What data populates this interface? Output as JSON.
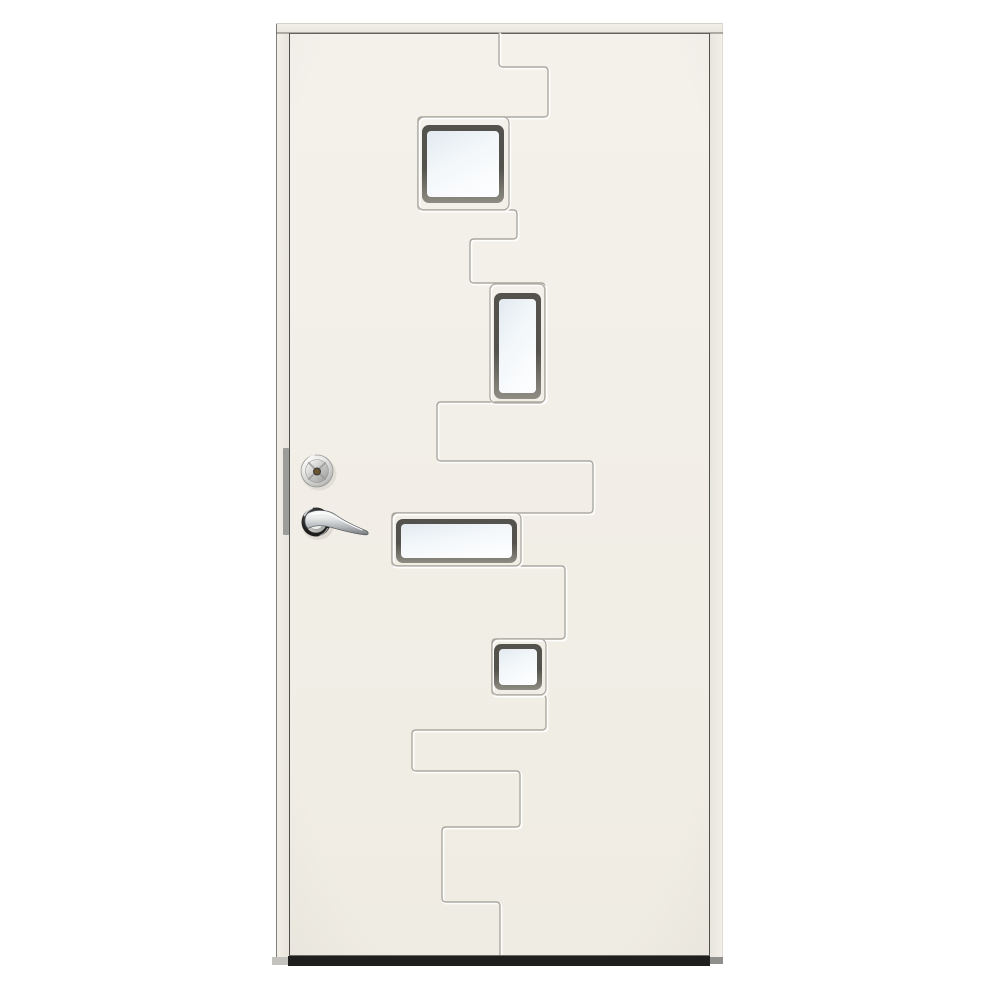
{
  "image_type": "product-photo",
  "subject": "White front entry door with stepped zigzag groove ornament, four frosted glass windows (square, tall rectangle, wide rectangle, small square), chrome lock cylinder and chrome lever handle on the left side, dark threshold at the bottom",
  "palette": {
    "background": "#ffffff",
    "door_face_top": "#f4f1eb",
    "door_face_bottom": "#efece3",
    "frame_face": "#f3f0ea",
    "frame_shade": "#e8e5dc",
    "edge_dark": "#6b6b66",
    "gap_dark": "#50504c",
    "edge_faint": "#c8c5bd",
    "groove": "#a8a49b",
    "groove_highlight": "#ffffff",
    "window_frame_top": "#53524c",
    "window_frame_bottom": "#8f8d83",
    "glass_edge": "#e2e9ef",
    "glass_mid": "#f3f7fa",
    "glass_light": "#fcfdfe",
    "threshold_dark": "#1f1f1d",
    "threshold_gray": "#c4c2bd",
    "threshold_gray2": "#8f8f8c",
    "strike_plate": "#9c9c99",
    "chrome_white": "#ffffff",
    "chrome_light": "#ebebea",
    "chrome_mid": "#c4c4c3",
    "chrome_dark": "#989896",
    "lever_top": "#ffffff",
    "lever_mid": "#e9ebec",
    "lever_low": "#b2b5b8",
    "lever_dark": "#6c7074",
    "lever_outline": "#55585c",
    "rosette_center": "#5a5a5a",
    "rosette_dark": "#1c1c1c",
    "keyhole_brass": "#6a5530",
    "keyhole_rim": "#3e3e3b",
    "shadow_soft": "#6f685c",
    "vignette": "#8a847a"
  },
  "geometry": {
    "frame_head": {
      "x": 276,
      "y": 23,
      "width": 447,
      "height": 10
    },
    "head_bottom_line": {
      "x1": 276,
      "y1": 33,
      "x2": 723,
      "y2": 33
    },
    "head_top_line": {
      "x1": 276,
      "y1": 23.5,
      "x2": 723,
      "y2": 23.5
    },
    "left_jamb": {
      "x": 276,
      "y": 33,
      "width": 13,
      "height": 925
    },
    "right_jamb": {
      "x": 710,
      "y": 33,
      "width": 13,
      "height": 925
    },
    "left_jamb_outer": {
      "x1": 276.5,
      "y1": 24,
      "x2": 276.5,
      "y2": 958
    },
    "right_jamb_outer": {
      "x1": 722.5,
      "y1": 24,
      "x2": 722.5,
      "y2": 958
    },
    "door_leaf": {
      "x": 289,
      "y": 33,
      "width": 421,
      "height": 923
    },
    "gap_left": {
      "x1": 289.5,
      "y1": 33,
      "x2": 289.5,
      "y2": 956
    },
    "gap_right": {
      "x1": 709.5,
      "y1": 33,
      "x2": 709.5,
      "y2": 956
    },
    "gap_top": {
      "x1": 290,
      "y1": 33.5,
      "x2": 710,
      "y2": 33.5
    },
    "leaf_bottom_line": {
      "x1": 289,
      "y1": 955.5,
      "x2": 710,
      "y2": 955.5
    },
    "vignette_overlay": {
      "x": 290,
      "y": 34,
      "width": 419,
      "height": 921
    },
    "groove_points": [
      [
        499,
        33
      ],
      [
        499,
        67
      ],
      [
        548,
        67
      ],
      [
        548,
        117
      ],
      [
        418,
        117
      ],
      [
        418,
        210
      ],
      [
        517,
        210
      ],
      [
        517,
        239
      ],
      [
        470,
        239
      ],
      [
        470,
        283
      ],
      [
        545,
        283
      ],
      [
        545,
        402
      ],
      [
        437,
        402
      ],
      [
        437,
        461
      ],
      [
        593,
        461
      ],
      [
        593,
        513
      ],
      [
        392,
        513
      ],
      [
        392,
        566
      ],
      [
        565,
        566
      ],
      [
        565,
        639
      ],
      [
        492,
        639
      ],
      [
        492,
        695
      ],
      [
        546,
        695
      ],
      [
        546,
        730
      ],
      [
        412,
        730
      ],
      [
        412,
        771
      ],
      [
        520,
        771
      ],
      [
        520,
        827
      ],
      [
        442,
        827
      ],
      [
        442,
        902
      ],
      [
        500,
        902
      ],
      [
        500,
        956
      ]
    ],
    "windows": {
      "w1": {
        "recess": {
          "x": 418,
          "y": 117,
          "width": 91,
          "height": 93,
          "rx": 6
        },
        "frame": {
          "x": 422,
          "y": 125,
          "width": 82,
          "height": 78,
          "rx": 7
        },
        "glass": {
          "x": 427,
          "y": 131,
          "width": 72,
          "height": 66,
          "rx": 4
        }
      },
      "w2": {
        "recess": {
          "x": 490,
          "y": 284,
          "width": 55,
          "height": 119,
          "rx": 6
        },
        "frame": {
          "x": 494,
          "y": 293,
          "width": 47,
          "height": 106,
          "rx": 7
        },
        "glass": {
          "x": 499,
          "y": 299,
          "width": 37,
          "height": 94,
          "rx": 4
        }
      },
      "w3": {
        "recess": {
          "x": 392,
          "y": 513,
          "width": 129,
          "height": 53,
          "rx": 6
        },
        "frame": {
          "x": 396,
          "y": 519,
          "width": 121,
          "height": 44,
          "rx": 7
        },
        "glass": {
          "x": 401,
          "y": 524,
          "width": 111,
          "height": 34,
          "rx": 4
        }
      },
      "w4": {
        "recess": {
          "x": 492,
          "y": 639,
          "width": 54,
          "height": 56,
          "rx": 6
        },
        "frame": {
          "x": 494,
          "y": 644,
          "width": 48,
          "height": 46,
          "rx": 7
        },
        "glass": {
          "x": 499,
          "y": 649,
          "width": 38,
          "height": 36,
          "rx": 4
        }
      }
    },
    "threshold_main": {
      "x": 288,
      "y": 956,
      "width": 422,
      "height": 10
    },
    "threshold_left": {
      "x": 272,
      "y": 957,
      "width": 16,
      "height": 8
    },
    "threshold_right": {
      "x": 710,
      "y": 957,
      "width": 13,
      "height": 7
    },
    "strike_plate": {
      "x": 283,
      "y": 448,
      "width": 6,
      "height": 87,
      "rx": 1
    },
    "cylinder_shadow": {
      "cx": 319,
      "cy": 474,
      "rx": 17.5,
      "ry": 16.5
    },
    "cylinder_outer": {
      "cx": 317,
      "cy": 471,
      "r": 16
    },
    "cylinder_inner": {
      "cx": 317,
      "cy": 471,
      "r": 11.5
    },
    "cylinder_cross_1": {
      "x1": 308.9,
      "y1": 462.9,
      "x2": 325.1,
      "y2": 479.1
    },
    "cylinder_cross_2": {
      "x1": 325.1,
      "y1": 462.9,
      "x2": 308.9,
      "y2": 479.1
    },
    "cylinder_glint": {
      "d": "M 305.5,462 A 16,16 0 0 1 314,455.4"
    },
    "keyhole": {
      "cx": 317,
      "cy": 471.5,
      "r": 3.4
    },
    "rosette_shadow": {
      "cx": 318,
      "cy": 525,
      "rx": 16,
      "ry": 15
    },
    "rosette_outer": {
      "cx": 316,
      "cy": 522,
      "r": 14.5
    },
    "rosette_ring": {
      "cx": 316,
      "cy": 522,
      "r": 11
    },
    "rosette_hub": {
      "cx": 316,
      "cy": 522,
      "r": 7.5
    },
    "rosette_glint_1": {
      "d": "M 304.5,515.5 A 14.5,14.5 0 0 1 312,508.3"
    },
    "rosette_glint_2": {
      "d": "M 327.5,528.5 A 14.5,14.5 0 0 1 320,535.5"
    },
    "lever": {
      "d": "M 309,512.5 C 319,508.5 330,510.5 336.5,515.5 C 348,523.5 359,527.5 365.5,530.5 C 369.5,532.4 369,535.2 364.5,534.8 C 354,533.8 341,530.2 330.5,527.2 C 320.5,524.4 312.5,525.8 308,528.6 C 303.5,524 304,515.5 309,512.5 Z"
    },
    "lever_highlight": {
      "d": "M 311,514.5 C 320,511.8 329,513 335.5,517 C 345,522.5 355,527 362,530"
    }
  }
}
